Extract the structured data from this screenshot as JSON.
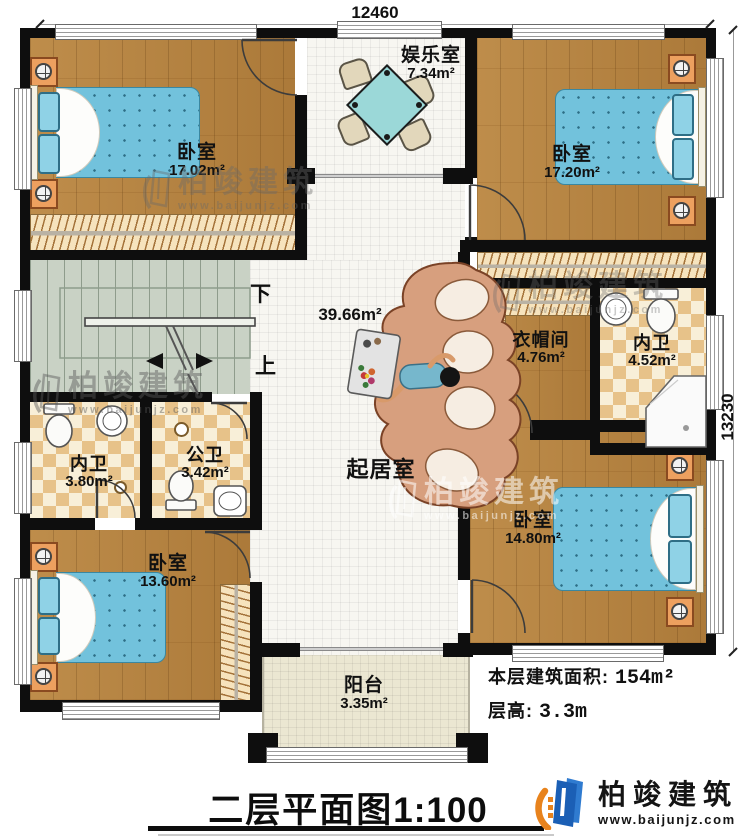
{
  "dimensions": {
    "width_label": "12460",
    "height_label": "13230"
  },
  "rooms": {
    "bedroom_tl": {
      "name": "卧室",
      "area": "17.02m²"
    },
    "entertainment": {
      "name": "娱乐室",
      "area": "7.34m²"
    },
    "bedroom_tr": {
      "name": "卧室",
      "area": "17.20m²"
    },
    "living": {
      "name": "起居室",
      "area": "39.66m²"
    },
    "cloakroom": {
      "name": "衣帽间",
      "area": "4.76m²"
    },
    "ensuite_right": {
      "name": "内卫",
      "area": "4.52m²"
    },
    "ensuite_left": {
      "name": "内卫",
      "area": "3.80m²"
    },
    "public_bath": {
      "name": "公卫",
      "area": "3.42m²"
    },
    "bedroom_bl": {
      "name": "卧室",
      "area": "13.60m²"
    },
    "bedroom_br": {
      "name": "卧室",
      "area": "14.80m²"
    },
    "balcony": {
      "name": "阳台",
      "area": "3.35m²"
    }
  },
  "stairs": {
    "down_label": "下",
    "up_label": "上"
  },
  "notes": {
    "floor_area_label": "本层建筑面积:",
    "floor_area_value": "154m²",
    "floor_height_label": "层高:",
    "floor_height_value": "3.3m"
  },
  "title": {
    "text": "二层平面图",
    "scale": "1:100"
  },
  "logo": {
    "company": "柏竣建筑",
    "website": "www.baijunjz.com"
  },
  "watermark": {
    "company": "柏竣建筑",
    "website": "www.baijunjz.com"
  },
  "colors": {
    "wall": "#0e0e0e",
    "wood": "#b5823f",
    "tile": "#f7f6f1",
    "balcony_tile": "#ebe7d2",
    "bathroom_checker": "#e7c289",
    "stairs": "#c9d2c5",
    "bed": "#72c2dc",
    "table": "#9bd8d8",
    "logo_blue": "#1b5fb5",
    "logo_orange": "#e8831d"
  }
}
